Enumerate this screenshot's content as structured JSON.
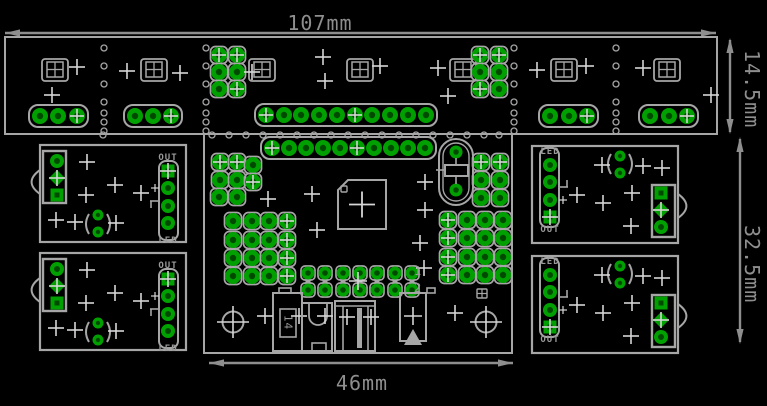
{
  "app": {
    "name": "pcb-panel-layout-view"
  },
  "labels": {
    "dim_top": "107mm",
    "dim_right_upper": "14.5mm",
    "dim_right_lower": "32.5mm",
    "dim_bottom": "46mm",
    "out": "OUT",
    "led": "LED",
    "pin1": "1",
    "pin2": "2",
    "comp14": "14"
  },
  "colors": {
    "bg": "#000000",
    "silk": "#A6A6A6",
    "dim": "#8E8E8E",
    "cross": "#D6D6D6",
    "pad": "#00A000",
    "hole": "#004A00",
    "label": "#9A9A9A"
  },
  "pcb": {
    "dims": [
      {
        "type": "h",
        "x1": 5,
        "x2": 716,
        "y": 33
      },
      {
        "type": "h",
        "x1": 209,
        "x2": 513,
        "y": 363
      },
      {
        "type": "v",
        "x": 730,
        "y1": 40,
        "y2": 132
      },
      {
        "type": "v",
        "x": 740,
        "y1": 139,
        "y2": 342
      }
    ],
    "strip": {
      "rect": [
        5,
        37,
        712,
        97
      ],
      "footprints": [
        55,
        154,
        262,
        360,
        463,
        564,
        667
      ],
      "fp_cy": 70,
      "headers3": {
        "y": 116,
        "groups": [
          [
            40,
            58,
            77
          ],
          [
            135,
            153,
            171
          ],
          [
            550,
            569,
            587
          ],
          [
            650,
            669,
            687
          ]
        ]
      },
      "header10": {
        "y": 115,
        "xs": [
          266,
          284,
          301,
          319,
          337,
          355,
          372,
          390,
          408,
          426
        ],
        "cross_idx": [
          0,
          5
        ]
      },
      "clusters": [
        {
          "pads": [
            [
              219,
              55
            ],
            [
              237,
              55
            ],
            [
              219,
              72
            ],
            [
              237,
              72
            ],
            [
              219,
              89
            ],
            [
              237,
              89
            ]
          ],
          "cross_idx": [
            0,
            1,
            5
          ]
        },
        {
          "pads": [
            [
              480,
              55
            ],
            [
              499,
              55
            ],
            [
              480,
              72
            ],
            [
              499,
              72
            ],
            [
              480,
              89
            ],
            [
              499,
              89
            ]
          ],
          "cross_idx": [
            0,
            1,
            4
          ]
        }
      ],
      "bite_cols": {
        "xs": [
          104,
          206,
          514,
          616
        ],
        "ys": [
          48,
          66,
          84,
          102,
          113,
          122,
          131
        ]
      },
      "bite_row": {
        "y": 135,
        "xs": [
          103,
          212,
          229,
          246,
          263,
          280,
          297,
          314,
          331,
          348,
          365,
          382,
          399,
          416,
          433,
          450,
          467,
          484,
          499
        ]
      },
      "crosses": [
        [
          77,
          67
        ],
        [
          52,
          95
        ],
        [
          127,
          71
        ],
        [
          180,
          73
        ],
        [
          252,
          72
        ],
        [
          323,
          57
        ],
        [
          325,
          81
        ],
        [
          380,
          66
        ],
        [
          438,
          68
        ],
        [
          448,
          96
        ],
        [
          537,
          70
        ],
        [
          586,
          66
        ],
        [
          643,
          68
        ],
        [
          711,
          95
        ]
      ]
    },
    "center": {
      "outline": [
        204,
        134,
        308,
        219
      ],
      "header10": {
        "y": 148,
        "xs": [
          272,
          289,
          306,
          323,
          340,
          357,
          374,
          391,
          408,
          425
        ],
        "cross_idx": [
          0,
          5
        ]
      },
      "cluster_ul": {
        "pads": [
          [
            220,
            162
          ],
          [
            237,
            162
          ],
          [
            253,
            165
          ],
          [
            220,
            180
          ],
          [
            237,
            180
          ],
          [
            253,
            182
          ],
          [
            219,
            197
          ],
          [
            237,
            197
          ]
        ],
        "cross_idx": [
          0,
          1,
          5
        ]
      },
      "cluster_ll": {
        "cols": [
          233,
          252,
          269,
          287
        ],
        "rows": [
          221,
          240,
          258,
          276
        ],
        "cross_col": 3
      },
      "cluster_ur": {
        "pads": [
          [
            481,
            162
          ],
          [
            500,
            162
          ],
          [
            481,
            180
          ],
          [
            500,
            180
          ],
          [
            481,
            198
          ],
          [
            500,
            198
          ]
        ],
        "cross_idx": [
          0,
          1
        ]
      },
      "cluster_lr": {
        "cols": [
          448,
          467,
          485,
          503
        ],
        "rows": [
          220,
          238,
          257,
          275
        ],
        "cross_col": 0
      },
      "crystal": {
        "outer": [
          439,
          139,
          34,
          66
        ],
        "inner": [
          443,
          143,
          26,
          58
        ],
        "pads": [
          [
            456,
            152
          ],
          [
            456,
            190
          ]
        ],
        "body": [
          445,
          165,
          23,
          11
        ],
        "tick_y": 170
      },
      "chip": {
        "rect": [
          338,
          180,
          48,
          49
        ],
        "pin1": [
          341,
          186,
          6,
          6
        ]
      },
      "header2x7": {
        "cols": [
          308,
          325,
          343,
          360,
          377,
          395,
          412
        ],
        "rows": [
          273,
          290
        ],
        "cross": [
          358,
          281
        ]
      },
      "comp14": {
        "rect": [
          273,
          293,
          29,
          58
        ],
        "tab": [
          279,
          288,
          12,
          5
        ],
        "inner": [
          280,
          309,
          16,
          28
        ]
      },
      "compu": {
        "rect": [
          302,
          303,
          30,
          48
        ],
        "u": {
          "x1": 309,
          "x2": 327,
          "ytop": 303,
          "ybot": 316
        },
        "foot": [
          312,
          343,
          14,
          8
        ],
        "cross": [
          325,
          316
        ]
      },
      "jack": {
        "rect": [
          335,
          301,
          40,
          50
        ],
        "topline_y": 306,
        "verts": [
          343,
          368
        ],
        "bar": [
          357,
          308,
          5,
          40
        ],
        "crosses": [
          [
            347,
            317
          ],
          [
            371,
            317
          ]
        ]
      },
      "diode": {
        "rect": [
          400,
          293,
          26,
          48
        ],
        "tab": [
          427,
          288,
          8,
          5
        ],
        "tri": [
          [
            413,
            329
          ],
          [
            404,
            345
          ],
          [
            422,
            345
          ]
        ],
        "cross": [
          413,
          316
        ]
      },
      "minifp": [
        477,
        289,
        10,
        9
      ],
      "holes": [
        [
          233,
          322
        ],
        [
          486,
          322
        ]
      ],
      "crosses": [
        [
          268,
          199
        ],
        [
          312,
          194
        ],
        [
          317,
          230
        ],
        [
          425,
          182
        ],
        [
          425,
          210
        ],
        [
          420,
          243
        ],
        [
          424,
          268
        ],
        [
          455,
          313
        ]
      ]
    },
    "side_board": {
      "outline": [
        40,
        145,
        146,
        97
      ],
      "notch": [
        40,
        182,
        12
      ],
      "connector": {
        "rect": [
          43,
          151,
          23,
          52
        ],
        "pads": [
          {
            "xy": [
              57,
              161
            ],
            "t": "donut"
          },
          {
            "xy": [
              57,
              178
            ],
            "t": "diamond",
            "cross": true
          },
          {
            "xy": [
              57,
              195
            ],
            "t": "square"
          }
        ]
      },
      "led": {
        "c": [
          98,
          224
        ],
        "pads": [
          [
            98,
            215
          ],
          [
            98,
            232
          ]
        ]
      },
      "outhdr": {
        "rect": [
          159,
          161,
          19,
          79
        ],
        "pads": [
          {
            "xy": [
              168,
              171
            ],
            "t": "square",
            "cross": true
          },
          {
            "xy": [
              168,
              188
            ],
            "t": "donut"
          },
          {
            "xy": [
              168,
              206
            ],
            "t": "donut"
          },
          {
            "xy": [
              168,
              223
            ],
            "t": "donut"
          }
        ]
      },
      "tsym": [
        [
          150,
          201,
          158,
          201
        ],
        [
          151,
          201,
          151,
          208
        ]
      ],
      "plus_small": [
        155,
        188
      ],
      "crosses": [
        [
          87,
          162
        ],
        [
          115,
          185
        ],
        [
          86,
          195
        ],
        [
          56,
          220
        ],
        [
          75,
          222
        ],
        [
          116,
          223
        ],
        [
          141,
          193
        ]
      ]
    },
    "board_instances": [
      {
        "name": "board-left-top",
        "dy": 0,
        "rot": false
      },
      {
        "name": "board-left-bottom",
        "dy": 108,
        "rot": false
      },
      {
        "name": "board-right-top",
        "dy": 0,
        "rot": true
      },
      {
        "name": "board-right-bottom",
        "dy": 110,
        "rot": true
      }
    ]
  }
}
